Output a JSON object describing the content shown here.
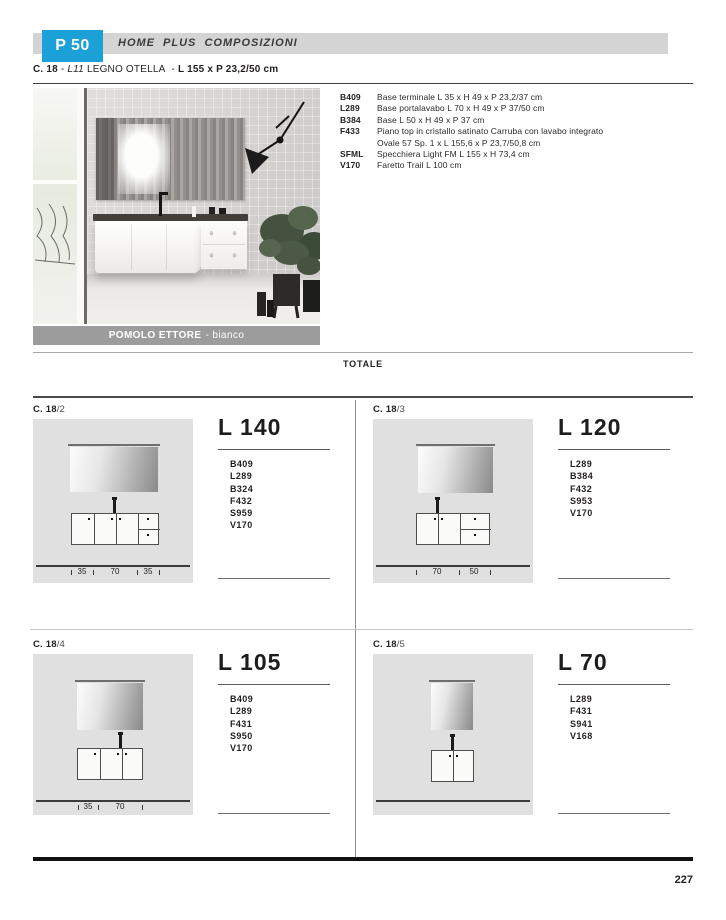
{
  "header": {
    "badge": "P 50",
    "title": "HOME PLUS COMPOSIZIONI"
  },
  "composition": {
    "code": "C. 18",
    "dash1": "-",
    "finish_code": "L11",
    "finish_name": "LEGNO OTELLA",
    "dash2": "-",
    "size": "L 155 x P 23,2/50 cm",
    "caption_bold": "POMOLO ETTORE",
    "caption_rest": "- bianco",
    "items": [
      {
        "code": "B409",
        "desc": "Base terminale L 35 x H 49 x P 23,2/37 cm"
      },
      {
        "code": "L289",
        "desc": "Base portalavabo L 70 x H 49 x P 37/50 cm"
      },
      {
        "code": "B384",
        "desc": "Base L 50 x H 49 x P 37 cm"
      },
      {
        "code": "F433",
        "desc": "Piano top in cristallo satinato Carruba con lavabo integrato",
        "desc2": "Ovale 57 Sp. 1 x L 155,6 x P 23,7/50,8 cm"
      },
      {
        "code": "SFML",
        "desc": "Specchiera Light  FM L 155 x H 73,4 cm"
      },
      {
        "code": "V170",
        "desc": "Faretto Trail L 100 cm"
      }
    ]
  },
  "totale_label": "TOTALE",
  "variants": [
    {
      "ref_code": "C. 18",
      "ref_suffix": "/2",
      "title": "L 140",
      "codes": [
        "B409",
        "L289",
        "B324",
        "F432",
        "S959",
        "V170"
      ],
      "dims": [
        "35",
        "70",
        "35"
      ]
    },
    {
      "ref_code": "C. 18",
      "ref_suffix": "/3",
      "title": "L 120",
      "codes": [
        "L289",
        "B384",
        "F432",
        "S953",
        "V170"
      ],
      "dims": [
        "70",
        "50"
      ]
    },
    {
      "ref_code": "C. 18",
      "ref_suffix": "/4",
      "title": "L 105",
      "codes": [
        "B409",
        "L289",
        "F431",
        "S950",
        "V170"
      ],
      "dims": [
        "35",
        "70"
      ]
    },
    {
      "ref_code": "C. 18",
      "ref_suffix": "/5",
      "title": "L 70",
      "codes": [
        "L289",
        "F431",
        "S941",
        "V168"
      ],
      "dims": []
    }
  ],
  "page_number": "227",
  "colors": {
    "accent_blue": "#1ba1d8",
    "header_bar_gray": "#d4d4d4",
    "caption_bar_gray": "#9c9c9c",
    "diagram_panel_gray": "#e0e0e0"
  }
}
